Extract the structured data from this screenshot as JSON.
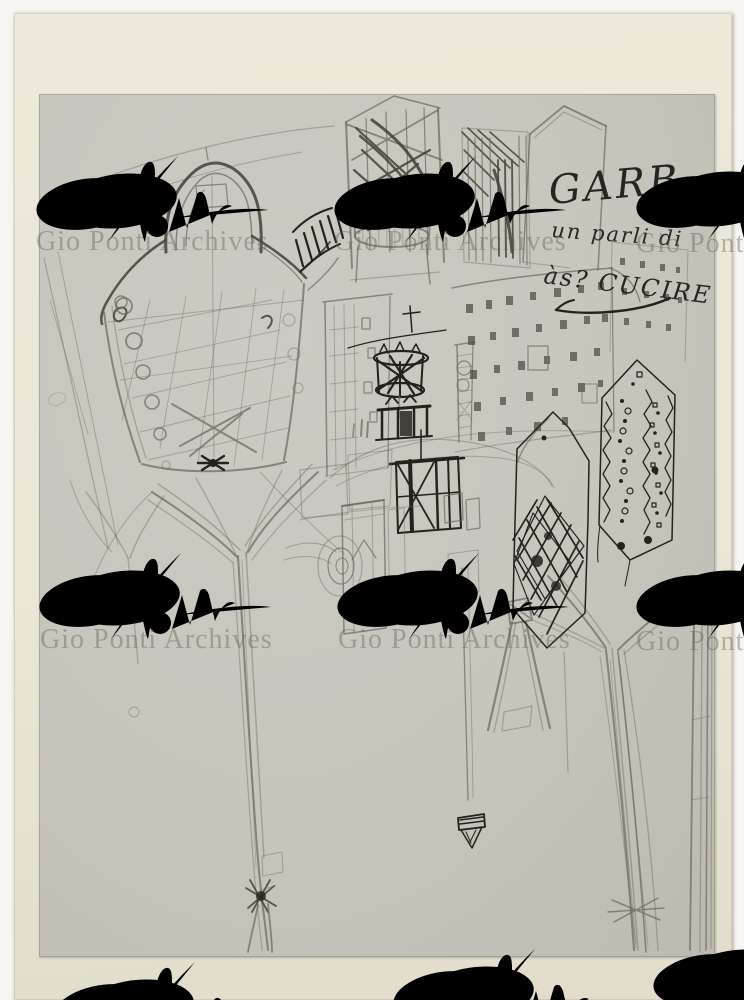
{
  "scan": {
    "outer_background": "#f6f5f1",
    "photo_paper_color": "#eae6d8",
    "sketch_paper_color": "#c7c5bc"
  },
  "watermark": {
    "text": "Gio Ponti Archives",
    "text_color": "rgba(100,95,86,0.42)",
    "flourish_color": "rgba(255,255,255,0.85)"
  },
  "handwriting": {
    "line1": "GARB,",
    "line2": "un parli di",
    "line3": "às?  CUCIRE",
    "ink_color": "#262521"
  },
  "sketch": {
    "pencil_color": "#6b695f",
    "pencil_dark_color": "#45433b",
    "ink_color": "#23221d",
    "subjects": "hooded garment with buttons, shaded tower, hatched facade, gabled house, plaza with ink crown chandelier and pavilion, window walls, two patterned hexagonal tower faces, forked tree pylons, thin triangular towers"
  }
}
